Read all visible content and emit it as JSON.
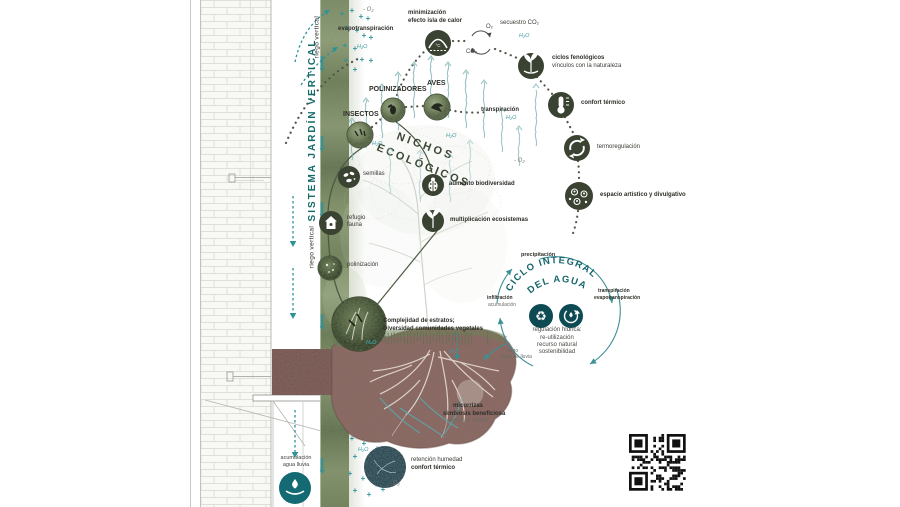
{
  "diagram": {
    "title_vertical": "SISTEMA JARDÍN VERTICAL",
    "riego_vertical": "riego vertical",
    "labels": {
      "evapotranspiracion": "evapotranspiración",
      "minus_o2": "- O₂",
      "h2o": "H₂O",
      "minimizacion": [
        "minimización",
        "efecto isla de calor"
      ],
      "o2": "O₂",
      "co2": "CO₂",
      "secuestro_co2": "secuestro CO₂",
      "transpiracion": "transpiración"
    },
    "benefit_chain": [
      {
        "icon": "sprout-hand-icon",
        "lines": [
          "ciclos fenológicos",
          "vínculos con la naturaleza"
        ]
      },
      {
        "icon": "thermometer-icon",
        "lines": [
          "confort térmico"
        ]
      },
      {
        "icon": "thermoregulation-icon",
        "lines": [
          "termoregulación"
        ]
      },
      {
        "icon": "community-icon",
        "lines": [
          "espacio artístico y divulgativo"
        ]
      }
    ],
    "fauna": {
      "insectos": "INSECTOS",
      "polinizadores": "POLINIZADORES",
      "aves": "AVES"
    },
    "nichos": {
      "arc": [
        "NICHOS",
        "ECOLÓGICOS"
      ],
      "semillas": "semillas",
      "refugio": [
        "refugio",
        "fauna"
      ],
      "polinizacion": "polinización",
      "aumento": "aumento biodiversidad",
      "multiplicacion": "multiplicación ecosistemas",
      "complejidad": [
        "Complejidad de estratos;",
        "Diversidad comunidades vegetales"
      ]
    },
    "water_cycle": {
      "title": [
        "CICLO INTEGRAL",
        "DEL AGUA"
      ],
      "precipitacion": "precipitación",
      "transpiracion": "transpiración",
      "evapotranspiracion": "evapotranspiración",
      "infiltracion": "infiltración",
      "acumulacion": "acumulación",
      "riego": "riego",
      "agua_de_lluvia": "agua de lluvia",
      "center": [
        "regulación hídrica:",
        "re-utilización",
        "recurso natural",
        "sostenibilidad"
      ]
    },
    "soil": {
      "micorrizas": "micorrizas",
      "simbiosis": "simbiosis beneficiosa",
      "mycos": "mycos + rhizas",
      "retencion": "retención humedad",
      "confort": "confort térmico",
      "minus_o2": "- O₂"
    },
    "rain": {
      "lines": [
        "acumulación",
        "agua lluvia"
      ]
    },
    "colors": {
      "teal": "#2b8d93",
      "dark_teal": "#0f4f58",
      "olive": "#3a4232",
      "title": "#156b68",
      "green_loop": "#4c5a41"
    }
  }
}
